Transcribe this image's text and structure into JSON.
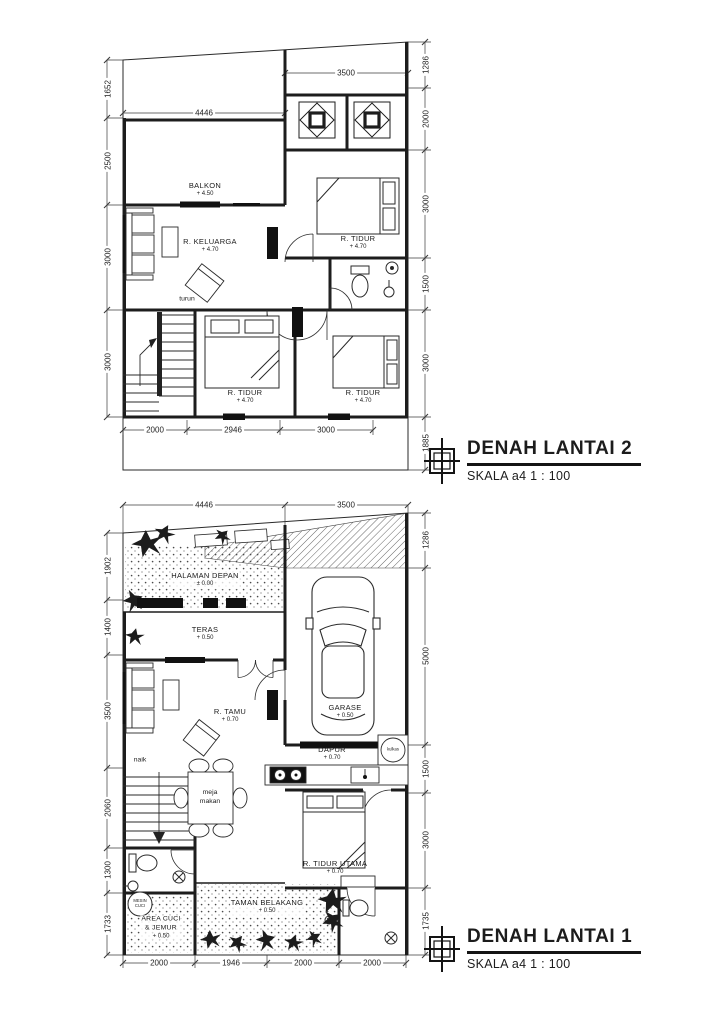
{
  "document": {
    "background": "#ffffff",
    "ink": "#1c1c1c"
  },
  "floor2": {
    "title": "DENAH LANTAI 2",
    "scale": "SKALA a4 1 : 100",
    "stair_label": "turun",
    "rooms": {
      "balkon": {
        "name": "BALKON",
        "elev": "+ 4.50"
      },
      "keluarga": {
        "name": "R. KELUARGA",
        "elev": "+ 4.70"
      },
      "tidur_atas": {
        "name": "R. TIDUR",
        "elev": "+ 4.70"
      },
      "tidur_tengah": {
        "name": "R. TIDUR",
        "elev": "+ 4.70"
      },
      "tidur_kanan": {
        "name": "R. TIDUR",
        "elev": "+ 4.70"
      }
    },
    "dims": {
      "top": [
        "3500"
      ],
      "inner": [
        "4446"
      ],
      "left": [
        "1652",
        "2500",
        "3000",
        "3000"
      ],
      "right": [
        "1286",
        "2000",
        "3000",
        "1500",
        "3000",
        "1885"
      ],
      "bottom": [
        "2000",
        "2946",
        "3000"
      ]
    }
  },
  "floor1": {
    "title": "DENAH LANTAI 1",
    "scale": "SKALA a4 1 : 100",
    "stair_label": "naik",
    "rooms": {
      "halaman": {
        "name": "HALAMAN DEPAN",
        "elev": "± 0.00"
      },
      "teras": {
        "name": "TERAS",
        "elev": "+ 0.50"
      },
      "tamu": {
        "name": "R. TAMU",
        "elev": "+ 0.70"
      },
      "garase": {
        "name": "GARASE",
        "elev": "+ 0.50"
      },
      "dapur": {
        "name": "DAPUR",
        "elev": "+ 0.70"
      },
      "tidur_utama": {
        "name": "R. TIDUR UTAMA",
        "elev": "+ 0.70"
      },
      "area_cuci": {
        "line1": "AREA CUCI",
        "line2": "& JEMUR",
        "elev": "+ 0.50"
      },
      "taman": {
        "name": "TAMAN BELAKANG",
        "elev": "+ 0.50"
      }
    },
    "labels": {
      "dining1": "meja",
      "dining2": "makan",
      "fridge": "kulkas",
      "washer1": "MESIN",
      "washer2": "CUCI"
    },
    "dims": {
      "top": [
        "4446",
        "3500"
      ],
      "left": [
        "1902",
        "1400",
        "3500",
        "2060",
        "1300",
        "1733"
      ],
      "right": [
        "1286",
        "5000",
        "1500",
        "3000",
        "1735"
      ],
      "bottom": [
        "2000",
        "1946",
        "2000",
        "2000"
      ]
    }
  }
}
